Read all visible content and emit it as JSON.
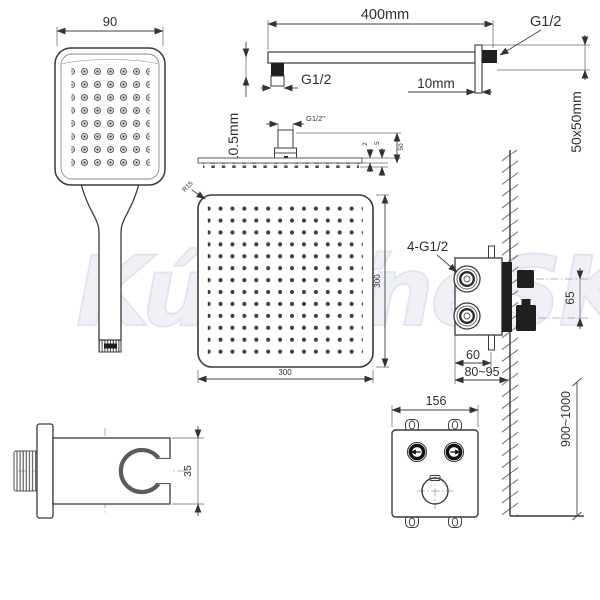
{
  "watermark": {
    "text": "KúpeľneSK"
  },
  "drawings": {
    "hand_shower": {
      "width": "90"
    },
    "arm": {
      "length": "400mm",
      "wall_thread": "G1/2",
      "head_thread": "G1/2",
      "escutcheon_thickness": "10mm",
      "escutcheon_size": "50x50mm",
      "drop_height": "10.5mm"
    },
    "head_side": {
      "thread": "G1/2\"",
      "plate_thickness": "2",
      "nozzle_height": "5",
      "connector_height": "50"
    },
    "head_front": {
      "corner_radius": "R15",
      "width": "300",
      "height": "300"
    },
    "valve": {
      "connections": "4-G1/2",
      "outlet_spacing": "65",
      "body_width": "60",
      "install_depth": "80~95"
    },
    "installation": {
      "height_range": "900~1000"
    },
    "panel": {
      "width": "156"
    },
    "holder": {
      "height": "35"
    }
  }
}
